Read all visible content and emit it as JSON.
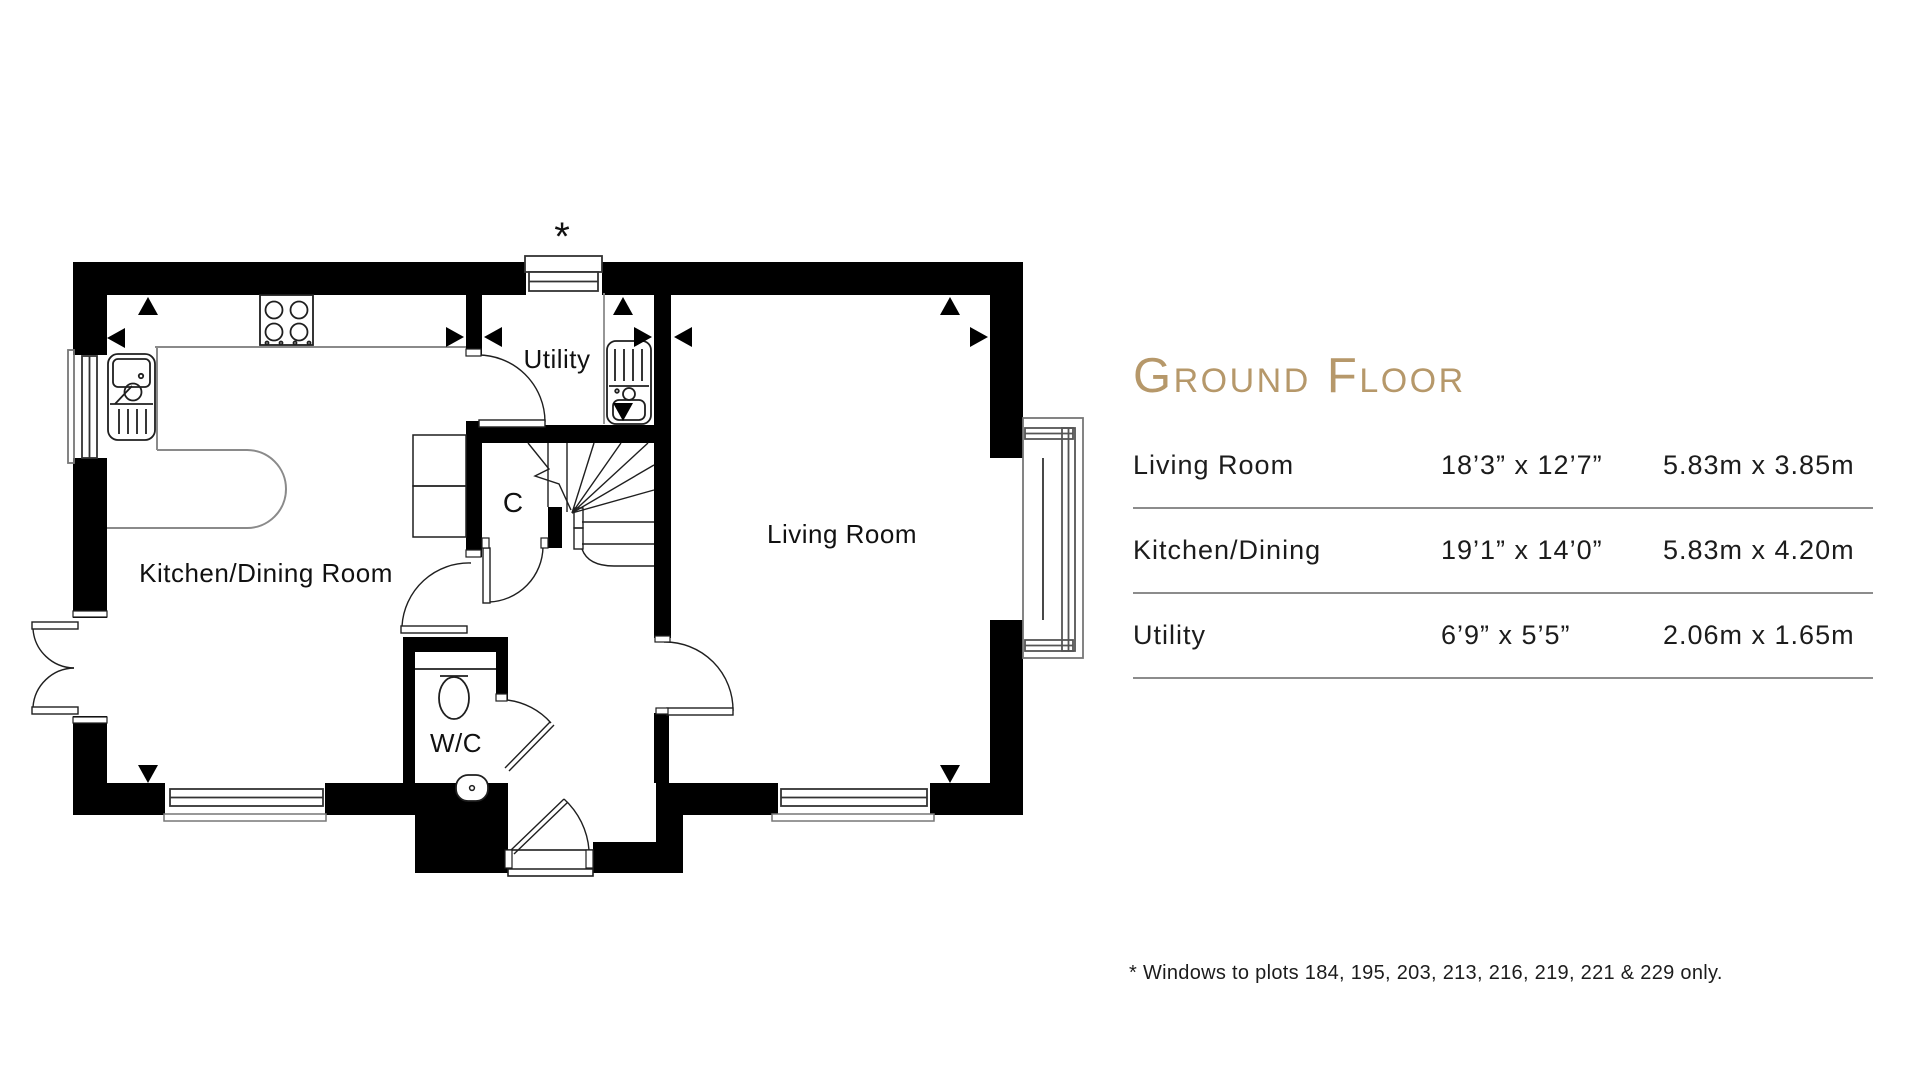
{
  "title": "Ground Floor",
  "accent_color": "#b6986a",
  "table": {
    "rows": [
      {
        "room": "Living Room",
        "imperial": "18’3” x 12’7”",
        "metric": "5.83m x 3.85m"
      },
      {
        "room": "Kitchen/Dining",
        "imperial": "19’1” x 14’0”",
        "metric": "5.83m x 4.20m"
      },
      {
        "room": "Utility",
        "imperial": "6’9” x 5’5”",
        "metric": "2.06m x 1.65m"
      }
    ]
  },
  "footnote": "* Windows to plots 184, 195, 203, 213, 216, 219, 221 & 229 only.",
  "floorplan": {
    "labels": {
      "kitchen": "Kitchen/Dining Room",
      "utility": "Utility",
      "living": "Living Room",
      "wc": "W/C",
      "cupboard": "C",
      "window_marker": "*"
    }
  }
}
